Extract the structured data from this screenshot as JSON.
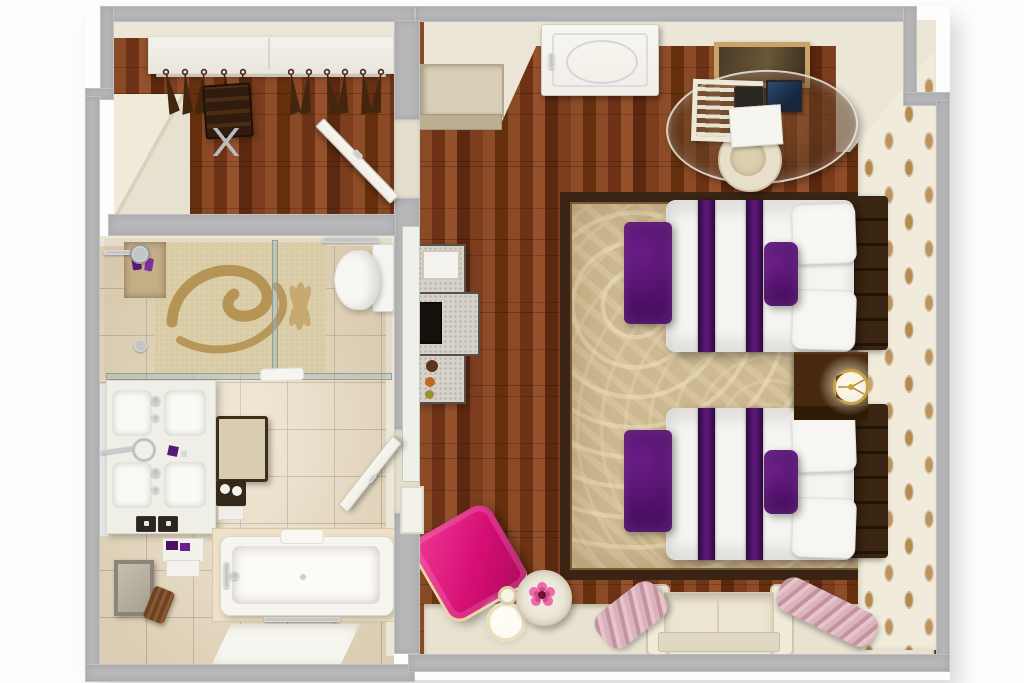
{
  "scene": {
    "title": "3D top-down floor plan render of a hotel guest room",
    "width_px": 1024,
    "height_px": 683
  },
  "palette": {
    "wall_gray": "#b7b6b8",
    "wall_cream": "#ebe6d6",
    "wood_base": "#7b3b1e",
    "tile": "#e9dcc2",
    "mosaic_bg": "#d8caa2",
    "mosaic_motif": "#b18e4c",
    "carpet": "#cdb88f",
    "carpet_border": "#3a2414",
    "wallpaper_bg": "#f1ebdb",
    "wallpaper_motif": "#b28a52",
    "bed_white": "#f5f4f0",
    "purple": "#4a0e63",
    "purple_light": "#6a1d86",
    "headboard": "#301d0d",
    "dark_wood": "#46290e",
    "gold": "#c9a243",
    "pink": "#d60e74",
    "curtain": "#d4a9b2",
    "sofa": "#ece5d2",
    "chrome": "#c2c4c6",
    "door_white": "#f0eee6",
    "glass": "#9fb4b6",
    "frame_tan": "#c8a468"
  },
  "rooms": {
    "closet": {
      "name": "Dressing area with open wardrobe",
      "items": [
        "wardrobe shelf",
        "clothes rail",
        "hangers",
        "luggage rack",
        "open door"
      ]
    },
    "bathroom": {
      "name": "Bathroom",
      "items": [
        "walk-in shower with mosaic floor",
        "glass partition",
        "shower head",
        "toilet",
        "double vanity with two basins",
        "magnifying mirror",
        "towel stool",
        "bathtub",
        "towel rail",
        "bath mat",
        "waste bin",
        "framed mirror",
        "door"
      ]
    },
    "bedroom": {
      "name": "Twin bedroom",
      "items": [
        "entry door",
        "wall picture",
        "luggage bench cabinet",
        "glass desk",
        "desk chair",
        "telephone",
        "laptop",
        "magazine rack",
        "TV console",
        "twin bed 1",
        "twin bed 2",
        "headboards",
        "purple foot benches",
        "nightstand",
        "table lamp",
        "patterned wallpaper wall",
        "area rug",
        "pink armchair",
        "floor lamp",
        "round side table with flower",
        "window sofa",
        "curtains"
      ]
    }
  }
}
